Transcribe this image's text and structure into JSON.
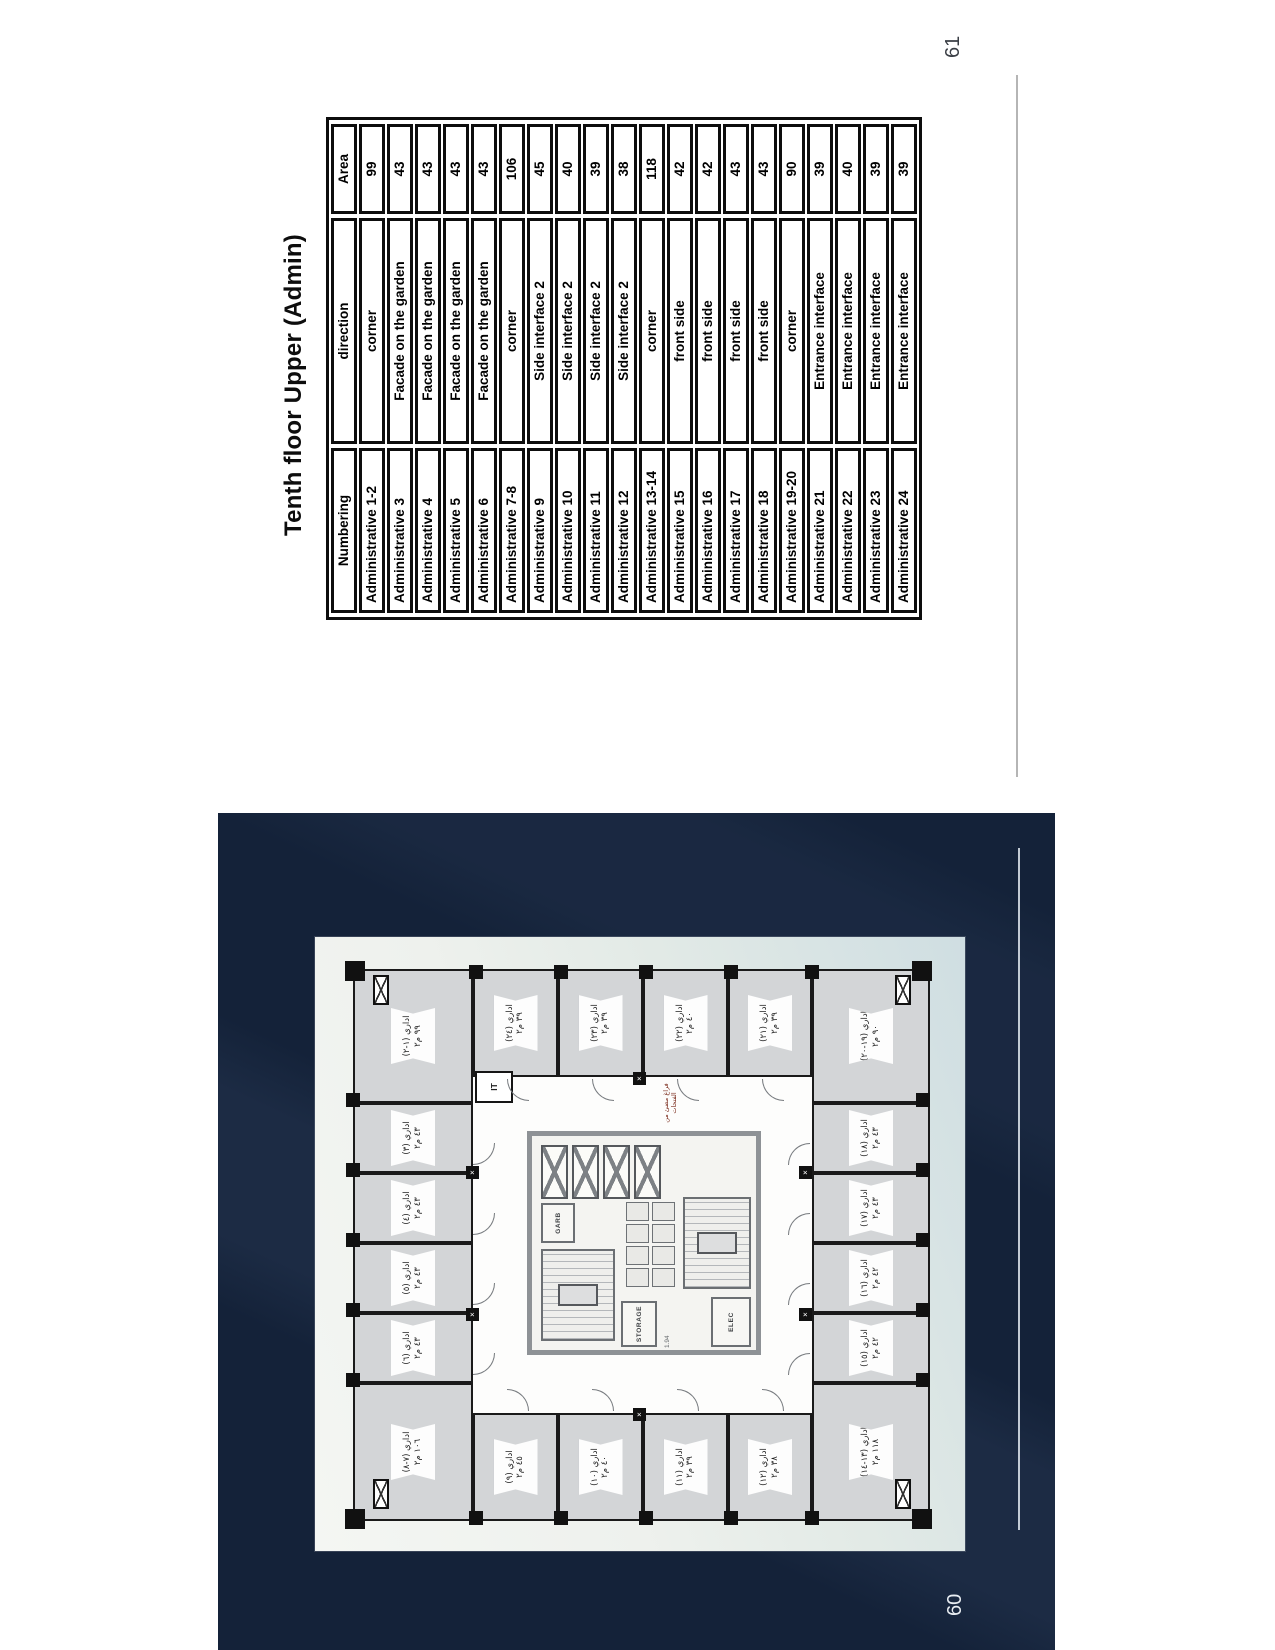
{
  "document": {
    "left_page_number": "60",
    "right_page_number": "61"
  },
  "table_page": {
    "title": "Tenth floor Upper (Admin)",
    "table": {
      "headers": [
        "Numbering",
        "direction",
        "Area"
      ],
      "rows": [
        [
          "Administrative 1-2",
          "corner",
          "99"
        ],
        [
          "Administrative 3",
          "Facade on the garden",
          "43"
        ],
        [
          "Administrative 4",
          "Facade on the garden",
          "43"
        ],
        [
          "Administrative 5",
          "Facade on the garden",
          "43"
        ],
        [
          "Administrative 6",
          "Facade on the garden",
          "43"
        ],
        [
          "Administrative 7-8",
          "corner",
          "106"
        ],
        [
          "Administrative 9",
          "Side interface 2",
          "45"
        ],
        [
          "Administrative 10",
          "Side interface 2",
          "40"
        ],
        [
          "Administrative 11",
          "Side interface 2",
          "39"
        ],
        [
          "Administrative 12",
          "Side interface 2",
          "38"
        ],
        [
          "Administrative 13-14",
          "corner",
          "118"
        ],
        [
          "Administrative 15",
          "front side",
          "42"
        ],
        [
          "Administrative 16",
          "front side",
          "42"
        ],
        [
          "Administrative 17",
          "front side",
          "43"
        ],
        [
          "Administrative 18",
          "front side",
          "43"
        ],
        [
          "Administrative 19-20",
          "corner",
          "90"
        ],
        [
          "Administrative 21",
          "Entrance interface",
          "39"
        ],
        [
          "Administrative 22",
          "Entrance interface",
          "40"
        ],
        [
          "Administrative 23",
          "Entrance interface",
          "39"
        ],
        [
          "Administrative 24",
          "Entrance interface",
          "39"
        ]
      ]
    }
  },
  "plan_page": {
    "rooms": [
      {
        "id": "7-8",
        "label": "اداري (٧-٨)",
        "area": "١٠٦ م٢"
      },
      {
        "id": "6",
        "label": "اداري (٦)",
        "area": "٤٣ م٢"
      },
      {
        "id": "5",
        "label": "اداري (٥)",
        "area": "٤٣ م٢"
      },
      {
        "id": "4",
        "label": "اداري (٤)",
        "area": "٤٣ م٢"
      },
      {
        "id": "3",
        "label": "اداري (٣)",
        "area": "٤٣ م٢"
      },
      {
        "id": "1-2",
        "label": "اداري (١-٢)",
        "area": "٩٩ م٢"
      },
      {
        "id": "9",
        "label": "اداري (٩)",
        "area": "٤٥ م٢"
      },
      {
        "id": "10",
        "label": "اداري (١٠)",
        "area": "٤٠ م٢"
      },
      {
        "id": "11",
        "label": "اداري (١١)",
        "area": "٣٩ م٢"
      },
      {
        "id": "12",
        "label": "اداري (١٢)",
        "area": "٣٨ م٢"
      },
      {
        "id": "24",
        "label": "اداري (٢٤)",
        "area": "٣٩ م٢"
      },
      {
        "id": "23",
        "label": "اداري (٢٣)",
        "area": "٣٩ م٢"
      },
      {
        "id": "22",
        "label": "اداري (٢٢)",
        "area": "٤٠ م٢"
      },
      {
        "id": "21",
        "label": "اداري (٢١)",
        "area": "٣٩ م٢"
      },
      {
        "id": "13-14",
        "label": "اداري (١٣-١٤)",
        "area": "١١٨ م٢"
      },
      {
        "id": "15",
        "label": "اداري (١٥)",
        "area": "٤٢ م٢"
      },
      {
        "id": "16",
        "label": "اداري (١٦)",
        "area": "٤٢ م٢"
      },
      {
        "id": "17",
        "label": "اداري (١٧)",
        "area": "٤٣ م٢"
      },
      {
        "id": "18",
        "label": "اداري (١٨)",
        "area": "٤٣ م٢"
      },
      {
        "id": "19-20",
        "label": "اداري (١٩-٢٠)",
        "area": "٩٠ م٢"
      }
    ],
    "core_labels": {
      "it": "IT",
      "garb": "GARB",
      "storage": "STORAGE",
      "elec": "ELEC",
      "dimension": "1.94"
    },
    "annotation": "فراغ مضئ من الفتحات"
  },
  "colors": {
    "page_bg": "#ffffff",
    "navy_bg": "#142239",
    "room_fill": "#d3d5d7",
    "wall": "#141414",
    "core_wall": "#8e9296",
    "footer_rule": "#b5b5b5",
    "right_page_number_color": "#3b3f46",
    "left_page_number_color": "#e8edf2"
  }
}
